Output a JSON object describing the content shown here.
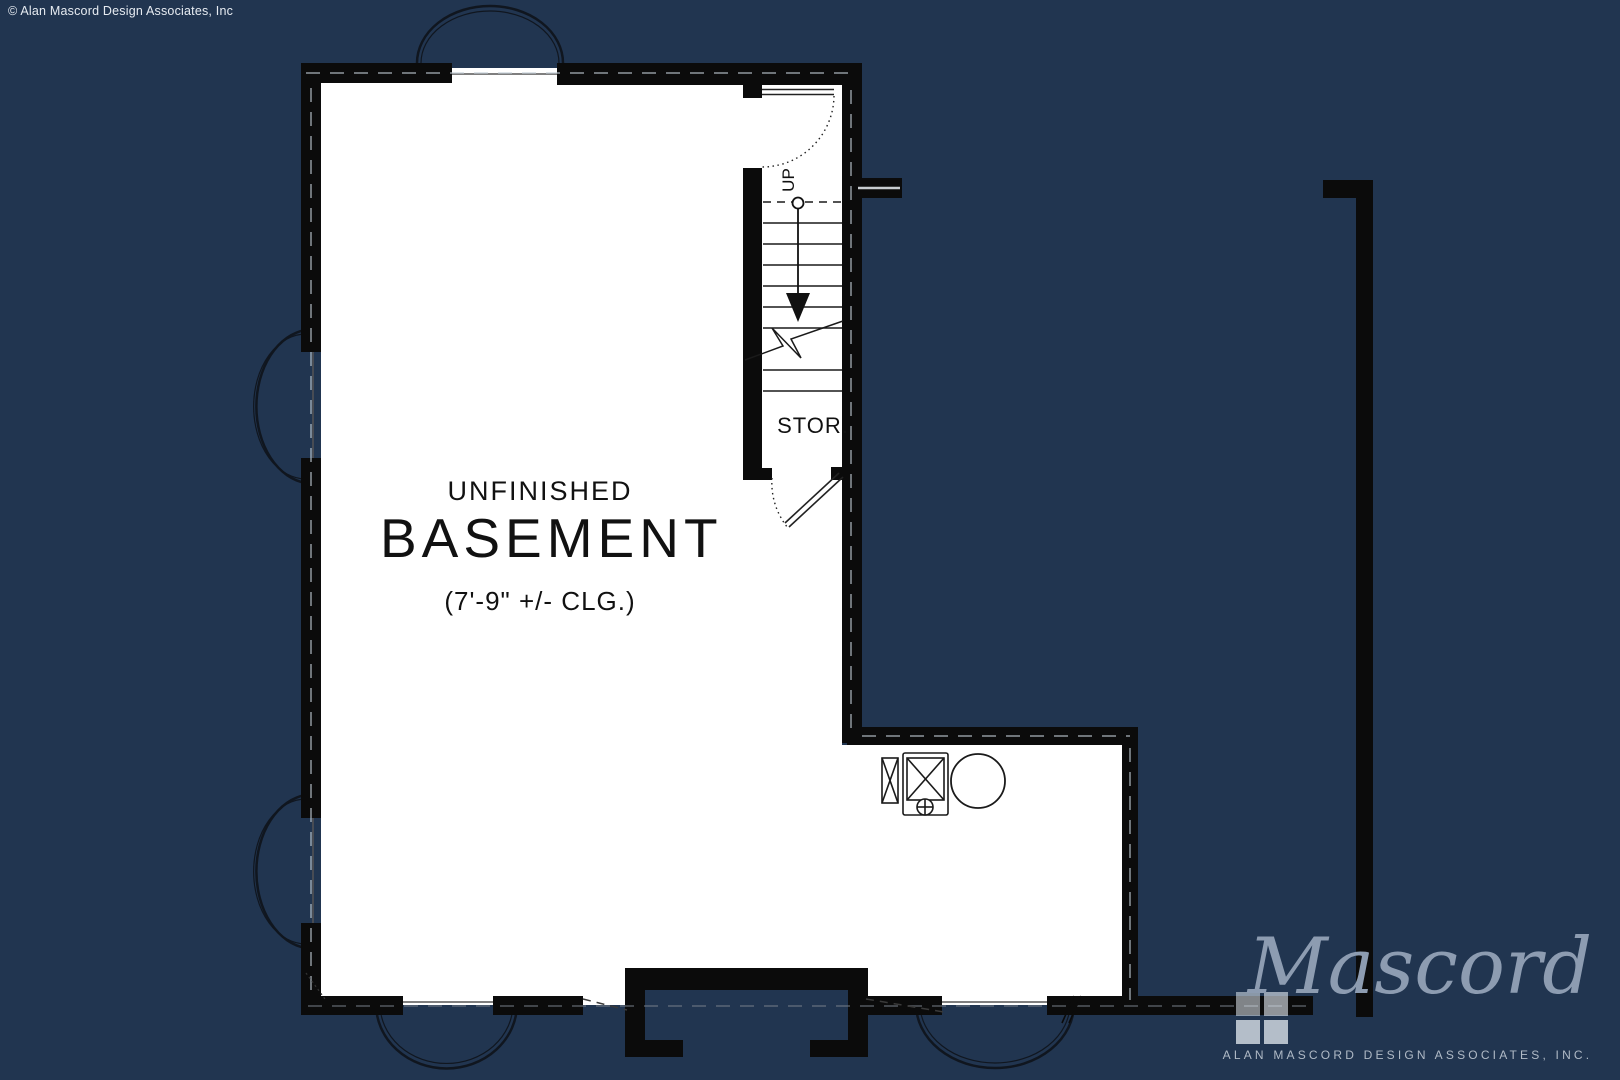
{
  "copyright": "© Alan Mascord Design Associates, Inc",
  "plan": {
    "room_title_line1": "UNFINISHED",
    "room_title_line2": "BASEMENT",
    "ceiling_note": "(7'-9\" +/- CLG.)",
    "storage_label": "STOR.",
    "stairs_direction_label": "UP"
  },
  "logo": {
    "script": "Mascord",
    "subtitle": "ALAN MASCORD DESIGN ASSOCIATES, INC."
  },
  "colors": {
    "background": "#213550",
    "wall": "#0b0b0b",
    "plan_floor": "#ffffff",
    "logo_text": "#8d9cb1",
    "logo_caps": "#b0bac6"
  }
}
